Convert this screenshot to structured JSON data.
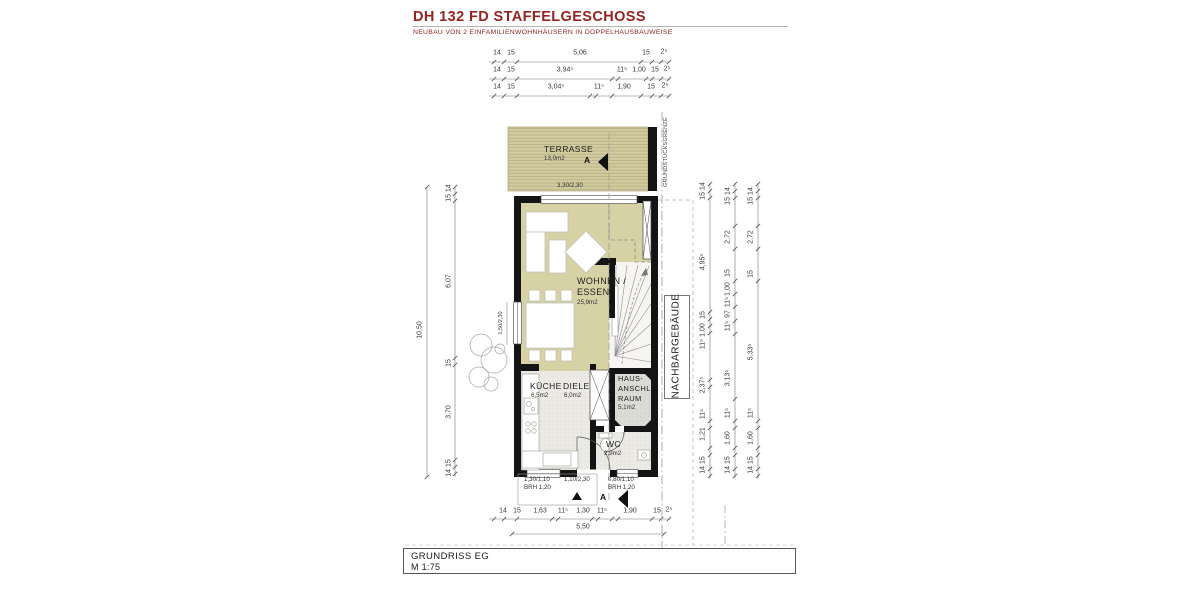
{
  "header": {
    "title": "DH 132 FD STAFFELGESCHOSS",
    "subtitle": "NEUBAU VON 2 EINFAMILIENWOHNHÄUSERN  IN DOPPELHAUSBAUWEISE"
  },
  "plan": {
    "rooms": {
      "terrasse": {
        "name": "TERRASSE",
        "area": "13,0m2"
      },
      "wohnen_line1": "WOHNEN /",
      "wohnen_line2": "ESSEN",
      "wohnen_area": "25,9m2",
      "kueche": {
        "name": "KÜCHE",
        "area": "6,5m2"
      },
      "diele": {
        "name": "DIELE",
        "area": "6,0m2"
      },
      "hausanschluss_line1": "HAUS-",
      "hausanschluss_line2": "ANSCHL.",
      "hausanschluss_line3": "RAUM",
      "hausanschluss_area": "5,1m2",
      "wc": {
        "name": "WC",
        "area": "2,9m2"
      }
    },
    "openings": {
      "terrace_door": "3,30/2,30",
      "left_window": "1,50/2,30",
      "window1_size": "1,30/1,10",
      "window1_brh": "BRH 1,20",
      "entry_door": "1,10/2,30",
      "window2_size": "0,80/1,10",
      "window2_brh": "BRH 1,20"
    },
    "markers": {
      "section_label": "A",
      "property_line": "GRUNDSTÜCKSGRENZE",
      "neighbor_building": "NACHBARGEBÄUDE"
    }
  },
  "dimensions": {
    "top_row1": [
      "14",
      "15",
      "5,06",
      "15",
      "2⁵"
    ],
    "top_row2": [
      "14",
      "15",
      "3,94⁵",
      "11⁵",
      "1,00",
      "15",
      "2⁵"
    ],
    "top_row3": [
      "14",
      "15",
      "3,04⁵",
      "11⁵",
      "1,90",
      "15",
      "2⁵"
    ],
    "bottom_row": [
      "14",
      "15",
      "1,63",
      "11⁵",
      "1,30",
      "11⁵",
      "1,90",
      "15",
      "2⁵"
    ],
    "bottom_total": "5,50",
    "left_total": "10,50",
    "left_col": [
      "15 14",
      "6,07",
      "15",
      "3,70",
      "14 15"
    ],
    "right_col1": [
      "15 14",
      "4,95⁵",
      "15",
      "1,00",
      "11⁵",
      "2,37⁵",
      "11⁵",
      "1,21",
      "14 15"
    ],
    "right_col2": [
      "15 14",
      "2,72",
      "15",
      "1,00",
      "11⁵",
      "97",
      "11⁵",
      "3,13⁵",
      "11⁵",
      "1,60",
      "14 15"
    ],
    "right_col3": [
      "15 14",
      "2,72",
      "15",
      "5,33⁵",
      "11⁵",
      "1,60",
      "14 15"
    ]
  },
  "title_block": {
    "drawing_name": "GRUNDRISS EG",
    "scale": "M 1:75"
  }
}
